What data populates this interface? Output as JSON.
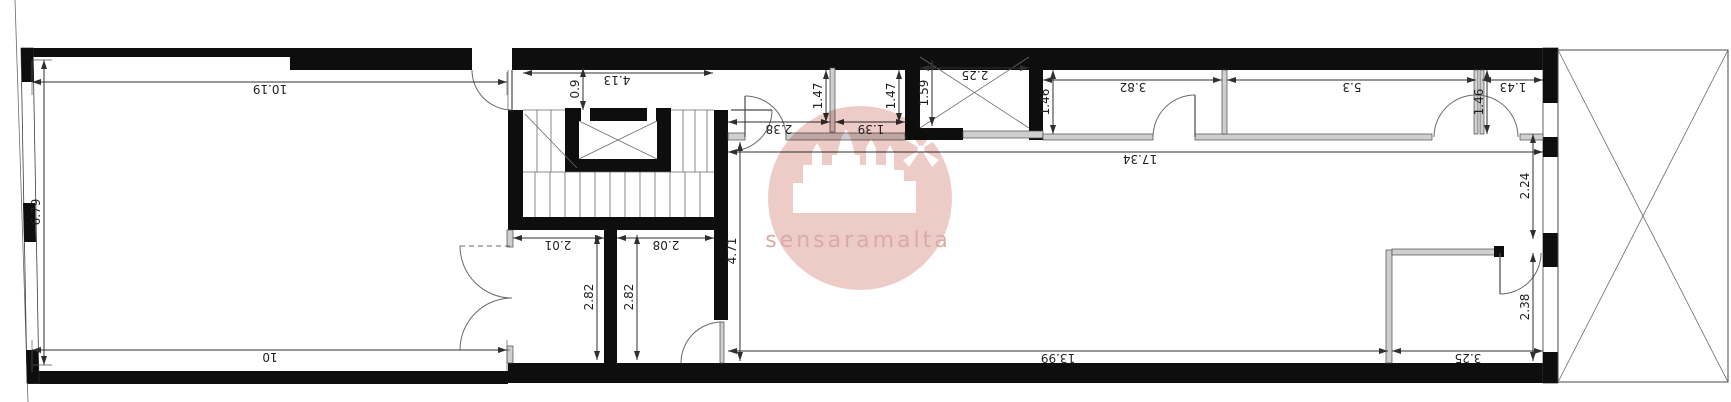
{
  "plan": {
    "watermark_text": "sensaramalta",
    "dimensions": {
      "left_room_width_top": "10.19",
      "left_room_width_bottom": "10",
      "left_room_depth": "6.79",
      "stairwell_width": "4.13",
      "stair_landing_depth": "0.9",
      "hall_width": "2.38",
      "wc1_depth": "1.47",
      "wc2_width": "1.39",
      "wc2_depth": "1.47",
      "shaft_width": "2.25",
      "shaft_depth": "1.59",
      "top_room1_width": "3.82",
      "top_room1_recess": "1.46",
      "top_total_length": "17.34",
      "top_room2_width": "5.3",
      "top_room3_width": "1.43",
      "top_room3_recess": "1.46",
      "store_a_width": "2.01",
      "store_a_depth": "2.82",
      "store_b_width": "2.08",
      "store_b_depth": "2.82",
      "living_room_length": "13.99",
      "living_room_depth": "4.71",
      "rear_room_width": "3.25",
      "rear_room_depth": "2.38",
      "rear_upper_depth": "2.24"
    },
    "colors": {
      "wall": "#0e0e0e",
      "dimension": "#2f2f2f",
      "sill_gray": "#cfcfcf",
      "watermark_pink": "#eac3bf",
      "watermark_text": "#d49b95"
    }
  }
}
